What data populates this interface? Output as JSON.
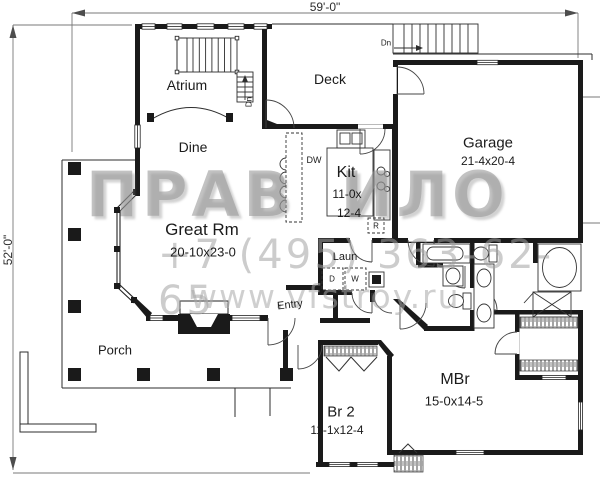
{
  "dimensions": {
    "top": "59'-0\"",
    "left": "52'-0\""
  },
  "rooms": {
    "atrium": {
      "label": "Atrium"
    },
    "dine": {
      "label": "Dine"
    },
    "deck": {
      "label": "Deck"
    },
    "kitchen": {
      "label": "Kit",
      "size_line1": "11-0x",
      "size_line2": "12-4"
    },
    "garage": {
      "label": "Garage",
      "size": "21-4x20-4"
    },
    "great_room": {
      "label": "Great Rm",
      "size": "20-10x23-0"
    },
    "laundry": {
      "label": "Laun"
    },
    "entry": {
      "label": "Entry"
    },
    "porch": {
      "label": "Porch"
    },
    "bedroom2": {
      "label": "Br 2",
      "size": "11-1x12-4"
    },
    "master_bedroom": {
      "label": "MBr",
      "size": "15-0x14-5"
    }
  },
  "appliances": {
    "dishwasher": "DW",
    "refrigerator": "R",
    "dryer": "D",
    "washer": "W"
  },
  "stairs": {
    "down": "Dn"
  },
  "watermark": {
    "title_left": "ПРАВ",
    "title_right": "ИЛО",
    "phone": "+7 (495) 363-62-65",
    "website": "www.vfstroy.ru"
  },
  "colors": {
    "wall": "#1a1a1a",
    "line": "#2e2e2e",
    "dimension": "#787878",
    "watermark": "#969696"
  }
}
